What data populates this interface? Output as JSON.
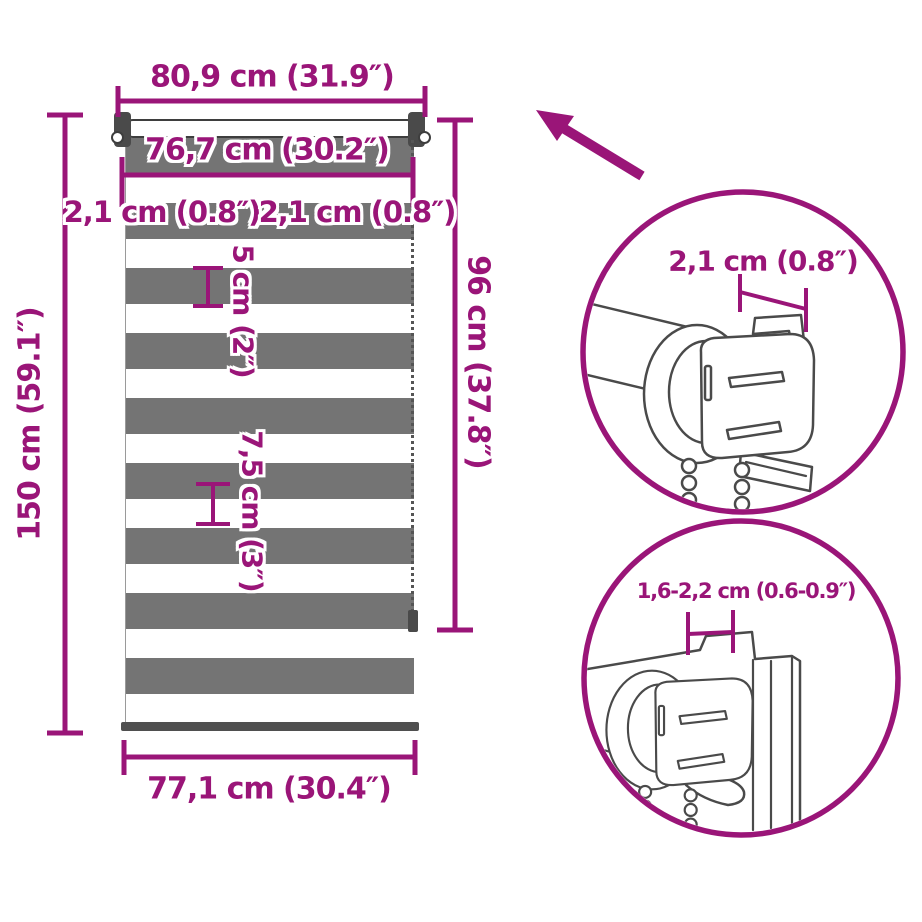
{
  "title": "Roller blind dimension diagram",
  "dimensions": {
    "width_total": "80,9 cm (31.9″)",
    "width_fabric": "76,7 cm (30.2″)",
    "gap_left": "2,1 cm (0.8″)",
    "gap_right": "2,1 cm (0.8″)",
    "height_total": "150 cm (59.1″)",
    "height_fabric": "96 cm (37.8″)",
    "stripe_small": "5 cm (2″)",
    "stripe_large": "7,5 cm (3″)",
    "width_bottom": "77,1 cm (30.4″)"
  },
  "details": {
    "top_circle_label": "2,1 cm (0.8″)",
    "bottom_circle_label": "1,6-2,2 cm (0.6-0.9″)"
  },
  "icons": {
    "arrow": "up-left-arrow-icon"
  },
  "colors": {
    "accent": "#9A1578",
    "stripe_gray": "#747474",
    "art_gray": "#4A4A4A",
    "hardware_dark": "#3E3E3E",
    "background": "#FFFFFF"
  }
}
